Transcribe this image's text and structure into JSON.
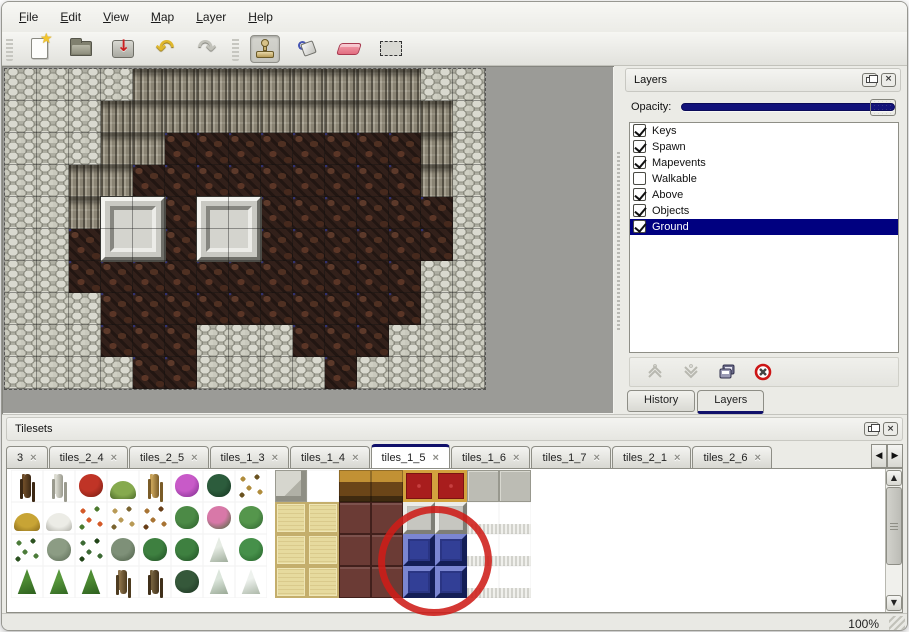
{
  "menu": {
    "items": [
      {
        "label": "File"
      },
      {
        "label": "Edit"
      },
      {
        "label": "View"
      },
      {
        "label": "Map"
      },
      {
        "label": "Layer"
      },
      {
        "label": "Help"
      }
    ]
  },
  "toolbar": {
    "groups": [
      [
        {
          "id": "new",
          "label": "New"
        },
        {
          "id": "open",
          "label": "Open"
        },
        {
          "id": "save",
          "label": "Save"
        },
        {
          "id": "undo",
          "label": "Undo"
        },
        {
          "id": "redo",
          "label": "Redo"
        }
      ],
      [
        {
          "id": "stamp",
          "label": "Stamp tool",
          "selected": true
        },
        {
          "id": "bucket",
          "label": "Fill tool"
        },
        {
          "id": "eraser",
          "label": "Eraser"
        },
        {
          "id": "select",
          "label": "Select"
        }
      ]
    ]
  },
  "map": {
    "tile_size": 32,
    "legend": {
      "S": "stone-scale",
      "C": "cliff-face",
      "F": "brown-floor"
    },
    "grid": [
      "SSSSCCCCCCCCCSS",
      "SSSCCCCCCCCCCCS",
      "SSSCCFFFFFFFFCS",
      "SSCCFFFFFFFFFCS",
      "SSCFFFFFFFFFFFS",
      "SSFFFFFFFFFFFFS",
      "SSFFFFFFFFFFFSS",
      "SSSFFFFFFFFFFSS",
      "SSSFFFSSSFFFSSS",
      "SSSSFFSSSSFSSSS"
    ],
    "pedestals": [
      {
        "col": 3,
        "row": 4
      },
      {
        "col": 6,
        "row": 4
      }
    ]
  },
  "layers_panel": {
    "title": "Layers",
    "opacity_label": "Opacity:",
    "layers": [
      {
        "name": "Keys",
        "checked": true,
        "selected": false
      },
      {
        "name": "Spawn",
        "checked": true,
        "selected": false
      },
      {
        "name": "Mapevents",
        "checked": true,
        "selected": false
      },
      {
        "name": "Walkable",
        "checked": false,
        "selected": false
      },
      {
        "name": "Above",
        "checked": true,
        "selected": false
      },
      {
        "name": "Objects",
        "checked": true,
        "selected": false
      },
      {
        "name": "Ground",
        "checked": true,
        "selected": true
      }
    ],
    "actions": [
      "move-up",
      "move-down",
      "duplicate",
      "delete"
    ],
    "tabs": [
      {
        "label": "History",
        "active": false
      },
      {
        "label": "Layers",
        "active": true
      }
    ]
  },
  "tilesets_panel": {
    "title": "Tilesets",
    "tabs": [
      {
        "label": "3",
        "active": false
      },
      {
        "label": "tiles_2_4",
        "active": false
      },
      {
        "label": "tiles_2_5",
        "active": false
      },
      {
        "label": "tiles_1_3",
        "active": false
      },
      {
        "label": "tiles_1_4",
        "active": false
      },
      {
        "label": "tiles_1_5",
        "active": true
      },
      {
        "label": "tiles_1_6",
        "active": false
      },
      {
        "label": "tiles_1_7",
        "active": false
      },
      {
        "label": "tiles_2_1",
        "active": false
      },
      {
        "label": "tiles_2_6",
        "active": false
      }
    ],
    "palette_left": [
      [
        {
          "s": "stalk",
          "c": "#6e4c28",
          "c2": "#3c2814"
        },
        {
          "s": "stalk",
          "c": "#dcdcd2",
          "c2": "#9a9a8e"
        },
        {
          "s": "blob",
          "c": "#c03426",
          "c2": "#701a10"
        },
        {
          "s": "mound",
          "c": "#86aa4e",
          "c2": "#4c6a2a"
        },
        {
          "s": "stalk",
          "c": "#c8a258",
          "c2": "#7a5c28"
        },
        {
          "s": "blob",
          "c": "#c85ac8",
          "c2": "#7a2a8a"
        },
        {
          "s": "blob",
          "c": "#2c5c3c",
          "c2": "#14321e"
        },
        {
          "s": "scatter",
          "c": "#b08c3c",
          "c2": "#6a5220"
        }
      ],
      [
        {
          "s": "mound",
          "c": "#c8a435",
          "c2": "#8a6c1c"
        },
        {
          "s": "mound",
          "c": "#ecece6",
          "c2": "#b0b0a8"
        },
        {
          "s": "scatter",
          "c": "#d45a28",
          "c2": "#4c7a2e"
        },
        {
          "s": "scatter",
          "c": "#b89a56",
          "c2": "#7a6430"
        },
        {
          "s": "scatter",
          "c": "#a87434",
          "c2": "#683f18"
        },
        {
          "s": "blob",
          "c": "#4c8a46",
          "c2": "#2a5c28"
        },
        {
          "s": "blob",
          "c": "#d878a8",
          "c2": "#3c6a34"
        },
        {
          "s": "blob",
          "c": "#55964c",
          "c2": "#2e6230"
        }
      ],
      [
        {
          "s": "scatter",
          "c": "#4c7c3a",
          "c2": "#2c5220"
        },
        {
          "s": "blob",
          "c": "#8c9c84",
          "c2": "#5a6a54"
        },
        {
          "s": "scatter",
          "c": "#3c6a34",
          "c2": "#224418"
        },
        {
          "s": "blob",
          "c": "#7e9078",
          "c2": "#4c5e46"
        },
        {
          "s": "blob",
          "c": "#3e8040",
          "c2": "#1e4c22"
        },
        {
          "s": "blob",
          "c": "#3e8040",
          "c2": "#1e4c22"
        },
        {
          "s": "tri",
          "c": "#e6ece4",
          "c2": "#9aa896"
        },
        {
          "s": "blob",
          "c": "#46904a",
          "c2": "#246028"
        }
      ],
      [
        {
          "s": "tri",
          "c": "#4e8c34",
          "c2": "#2a5c1c"
        },
        {
          "s": "tri",
          "c": "#58983c",
          "c2": "#2f6420"
        },
        {
          "s": "tri",
          "c": "#4e8c34",
          "c2": "#2a5c1c"
        },
        {
          "s": "stalk",
          "c": "#8a7048",
          "c2": "#4e3c20"
        },
        {
          "s": "stalk",
          "c": "#74603c",
          "c2": "#40301a"
        },
        {
          "s": "blob",
          "c": "#35583a",
          "c2": "#1a3220"
        },
        {
          "s": "tri",
          "c": "#dce6dc",
          "c2": "#94a490"
        },
        {
          "s": "tri",
          "c": "#eef2ee",
          "c2": "#a8b4a4"
        }
      ]
    ],
    "palette_right": [
      [
        "stone",
        "empty",
        "wood",
        "wood",
        "carpet",
        "carpet",
        "gray",
        "gray"
      ],
      [
        "cream",
        "cream",
        "maroon",
        "maroon",
        "metal",
        "metal",
        "curtain",
        "curtain"
      ],
      [
        "cream",
        "cream",
        "maroon",
        "maroon",
        "blue",
        "blue",
        "curtain",
        "curtain"
      ],
      [
        "cream",
        "cream",
        "maroon",
        "maroon",
        "blue",
        "blue",
        "curtain",
        "curtain"
      ]
    ],
    "annotation": {
      "shape": "red-circle",
      "target": "blue tile"
    }
  },
  "status_bar": {
    "zoom": "100%"
  }
}
